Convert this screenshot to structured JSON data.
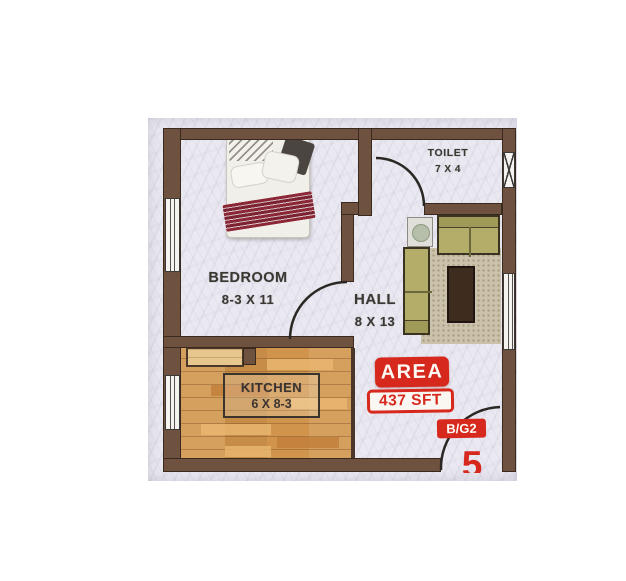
{
  "rooms": {
    "bedroom": {
      "name": "BEDROOM",
      "dims": "8-3 X 11"
    },
    "hall": {
      "name": "HALL",
      "dims": "8 X 13"
    },
    "kitchen": {
      "name": "KITCHEN",
      "dims": "6 X 8-3"
    },
    "toilet": {
      "name": "TOILET",
      "dims": "7 X 4"
    }
  },
  "badges": {
    "area_label": "AREA",
    "area_value": "437 SFT",
    "block_unit": "B/G2",
    "unit_number": "5"
  },
  "colors": {
    "wall_brown": "#6f5140",
    "wall_outline": "#3a291d",
    "marble_floor": "#eae8f0",
    "kitchen_wood": "#d0944c",
    "sofa_olive": "#b4ad6a",
    "table_brown": "#3e2c1e",
    "accent_red": "#d6281c",
    "label_text": "#3b3834"
  },
  "furniture_icons": [
    "bed",
    "l-sofa",
    "coffee-table",
    "rug",
    "side-table"
  ],
  "opening_icons": [
    "door-arc",
    "window-strip",
    "window-x"
  ]
}
